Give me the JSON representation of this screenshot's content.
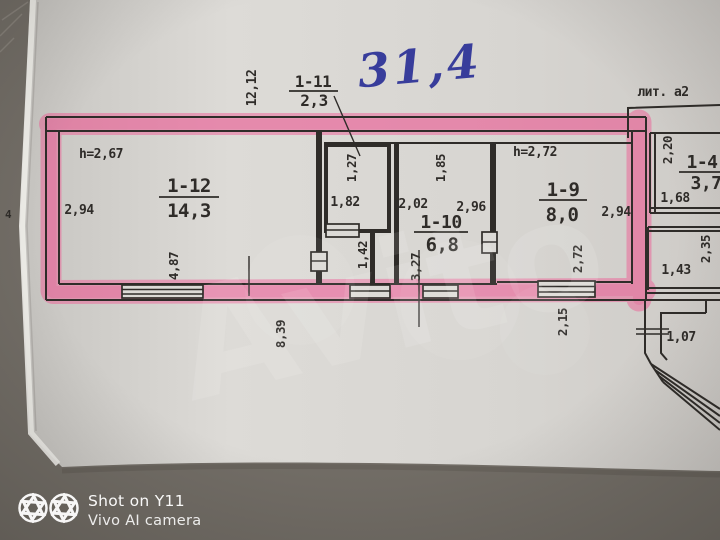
{
  "watermark": {
    "brand": "Avito"
  },
  "camera_overlay": {
    "logo": "aperture-icon",
    "line1": "Shot on Y11",
    "line2": "Vivo AI camera"
  },
  "plan": {
    "handwritten_total_area": "31,4",
    "building_litera": "лит. а2",
    "left_edge_mark": "4",
    "rooms": {
      "r12": {
        "id": "1-12",
        "area": "14,3",
        "ceiling_height": "h=2,67"
      },
      "r11": {
        "id": "1-11",
        "area": "2,3"
      },
      "r10": {
        "id": "1-10",
        "area": "6,8"
      },
      "r9": {
        "id": "1-9",
        "area": "8,0",
        "ceiling_height": "h=2,72"
      },
      "r4": {
        "id": "1-4",
        "area": "3,7"
      }
    },
    "dimensions": {
      "top_wall": "12,12",
      "r12_left_wall": "2,94",
      "r12_bottom_wall": "4,87",
      "bottom_wall_left": "8,39",
      "closet_depth": "1,27",
      "closet_width": "1,82",
      "closet_stub": "1,42",
      "r10_left": "2,02",
      "r10_niche": "1,85",
      "r10_right": "2,96",
      "r10_bottom": "3,27",
      "r9_right_wall": "2,94",
      "r9_window_wall": "2,72",
      "r9_below_wall": "2,15",
      "r4_left_upper": "2,20",
      "r4_lower": "1,68",
      "right_mid_room_width": "1,43",
      "right_mid_room_height": "2,35",
      "corridor_width": "1,07"
    }
  },
  "colors": {
    "highlighter_pink": "#ee6097",
    "ink": "#2f2c29",
    "pen_blue": "#383d9b",
    "paper": "#d8d6d2",
    "table_surface": "#726d66",
    "watermark_white": "#ffffff"
  }
}
